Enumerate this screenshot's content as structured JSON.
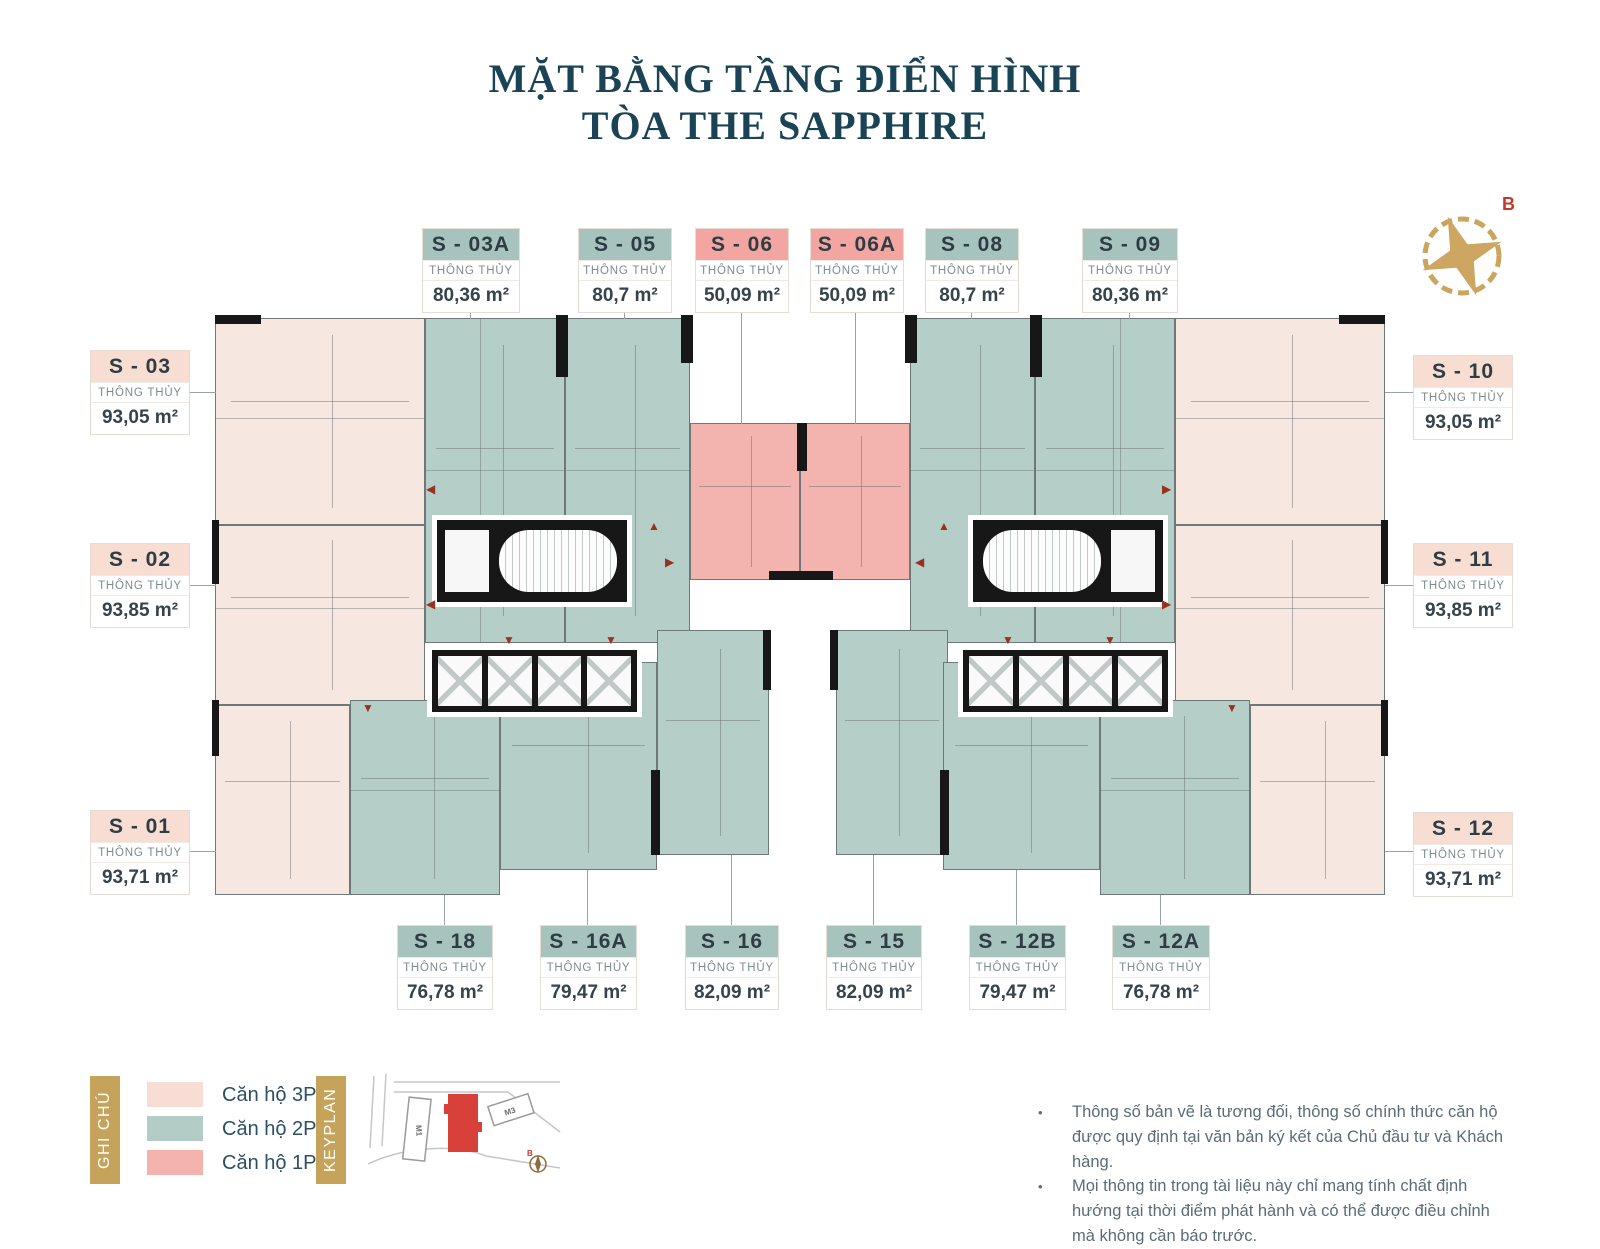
{
  "title": {
    "line1": "MẶT BẰNG TẦNG ĐIỂN HÌNH",
    "line2": "TÒA THE SAPPHIRE"
  },
  "compass": {
    "north_label": "B"
  },
  "area_label": "THÔNG THỦY",
  "units": {
    "top": [
      {
        "id": "S - 03A",
        "area": "80,36 m²",
        "type": "2PN"
      },
      {
        "id": "S - 05",
        "area": "80,7 m²",
        "type": "2PN"
      },
      {
        "id": "S - 06",
        "area": "50,09 m²",
        "type": "1PN"
      },
      {
        "id": "S - 06A",
        "area": "50,09 m²",
        "type": "1PN"
      },
      {
        "id": "S - 08",
        "area": "80,7 m²",
        "type": "2PN"
      },
      {
        "id": "S - 09",
        "area": "80,36 m²",
        "type": "2PN"
      }
    ],
    "left": [
      {
        "id": "S - 03",
        "area": "93,05 m²",
        "type": "3PN"
      },
      {
        "id": "S - 02",
        "area": "93,85 m²",
        "type": "3PN"
      },
      {
        "id": "S - 01",
        "area": "93,71 m²",
        "type": "3PN"
      }
    ],
    "right": [
      {
        "id": "S - 10",
        "area": "93,05 m²",
        "type": "3PN"
      },
      {
        "id": "S - 11",
        "area": "93,85 m²",
        "type": "3PN"
      },
      {
        "id": "S - 12",
        "area": "93,71 m²",
        "type": "3PN"
      }
    ],
    "bottom": [
      {
        "id": "S - 18",
        "area": "76,78 m²",
        "type": "2PN"
      },
      {
        "id": "S - 16A",
        "area": "79,47 m²",
        "type": "2PN"
      },
      {
        "id": "S - 16",
        "area": "82,09 m²",
        "type": "2PN"
      },
      {
        "id": "S - 15",
        "area": "82,09 m²",
        "type": "2PN"
      },
      {
        "id": "S - 12B",
        "area": "79,47 m²",
        "type": "2PN"
      },
      {
        "id": "S - 12A",
        "area": "76,78 m²",
        "type": "2PN"
      }
    ]
  },
  "legend": {
    "ghi_chu_label": "GHI CHÚ",
    "keyplan_label": "KEYPLAN",
    "items": [
      {
        "label": "Căn hộ 3PN",
        "color": "#f7ddd4"
      },
      {
        "label": "Căn hộ 2PN",
        "color": "#b3ccc5"
      },
      {
        "label": "Căn hộ 1PN",
        "color": "#f5b3b0"
      }
    ],
    "keyplan_buildings": {
      "m1": "M1",
      "m3": "M3"
    }
  },
  "notes": [
    "Thông số bản vẽ là tương đối, thông số chính thức căn hộ được quy định tại văn bản ký kết của Chủ đầu tư và Khách hàng.",
    "Mọi thông tin trong tài liệu này chỉ mang tính chất định hướng tại thời điểm phát hành và có thể được điều chỉnh mà không cần báo trước."
  ],
  "colors": {
    "title": "#1a4456",
    "gold": "#c6a35b",
    "apartment_3pn": "#f6e7e0",
    "apartment_2pn": "#b6cec8",
    "apartment_1pn": "#f3b3ae",
    "header_teal": "#a6c4bd",
    "header_pink": "#f3a5a2",
    "header_cream": "#f7ddd2",
    "north_red": "#c0392f",
    "walls": "#171717"
  }
}
